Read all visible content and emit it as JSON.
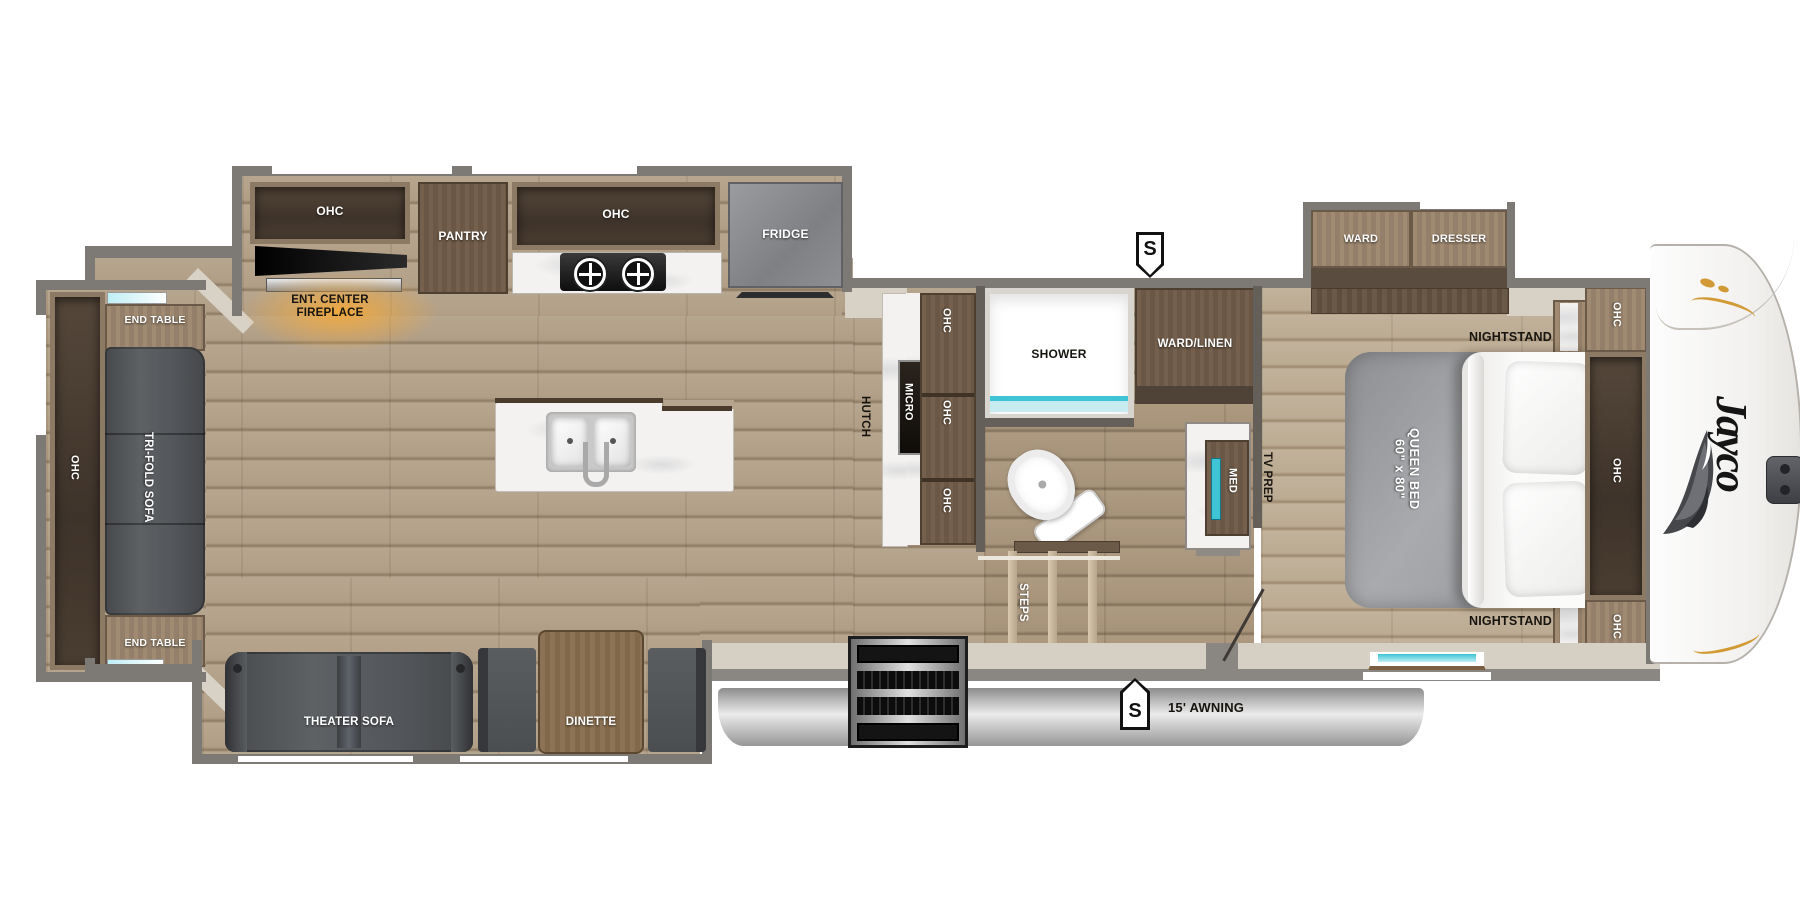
{
  "brand": {
    "logo": "Jayco"
  },
  "badges": {
    "top_s": "S",
    "bottom_s": "S"
  },
  "awning": {
    "label": "15' AWNING"
  },
  "rear_slide": {
    "ohc": "OHC",
    "end_table_top": "END TABLE",
    "tri_fold_sofa": "TRI-FOLD SOFA",
    "end_table_bottom": "END TABLE"
  },
  "kitchen": {
    "ohc_left": "OHC",
    "ent_line1": "ENT. CENTER",
    "ent_line2": "FIREPLACE",
    "pantry": "PANTRY",
    "ohc_right": "OHC",
    "fridge": "FRIDGE"
  },
  "galley": {
    "hutch": "HUTCH",
    "micro": "MICRO",
    "ohc_top": "OHC",
    "ohc_middle": "OHC",
    "ohc_bottom": "OHC"
  },
  "bathroom": {
    "shower": "SHOWER",
    "ward_linen": "WARD/LINEN",
    "med": "MED",
    "steps": "STEPS"
  },
  "bedroom": {
    "ward": "WARD",
    "dresser": "DRESSER",
    "nightstand_top": "NIGHTSTAND",
    "nightstand_bottom": "NIGHTSTAND",
    "bed_size": "60\" x 80\"",
    "bed_type": "QUEEN BED",
    "tv_prep": "TV PREP",
    "ohc_cabinet_top": "OHC",
    "ohc_cabinet_middle": "OHC",
    "ohc_cabinet_bottom": "OHC"
  },
  "door_slide": {
    "theater_sofa": "THEATER SOFA",
    "dinette": "DINETTE"
  },
  "colors": {
    "accent_teal": "#3ec4d5",
    "glow_orange": "#f2a93c",
    "floor_wood": "#b5a28b",
    "cabinet_brown": "#8a7460",
    "awning_gray": "#b9b9b9",
    "sofa_gray": "#585b5e"
  }
}
